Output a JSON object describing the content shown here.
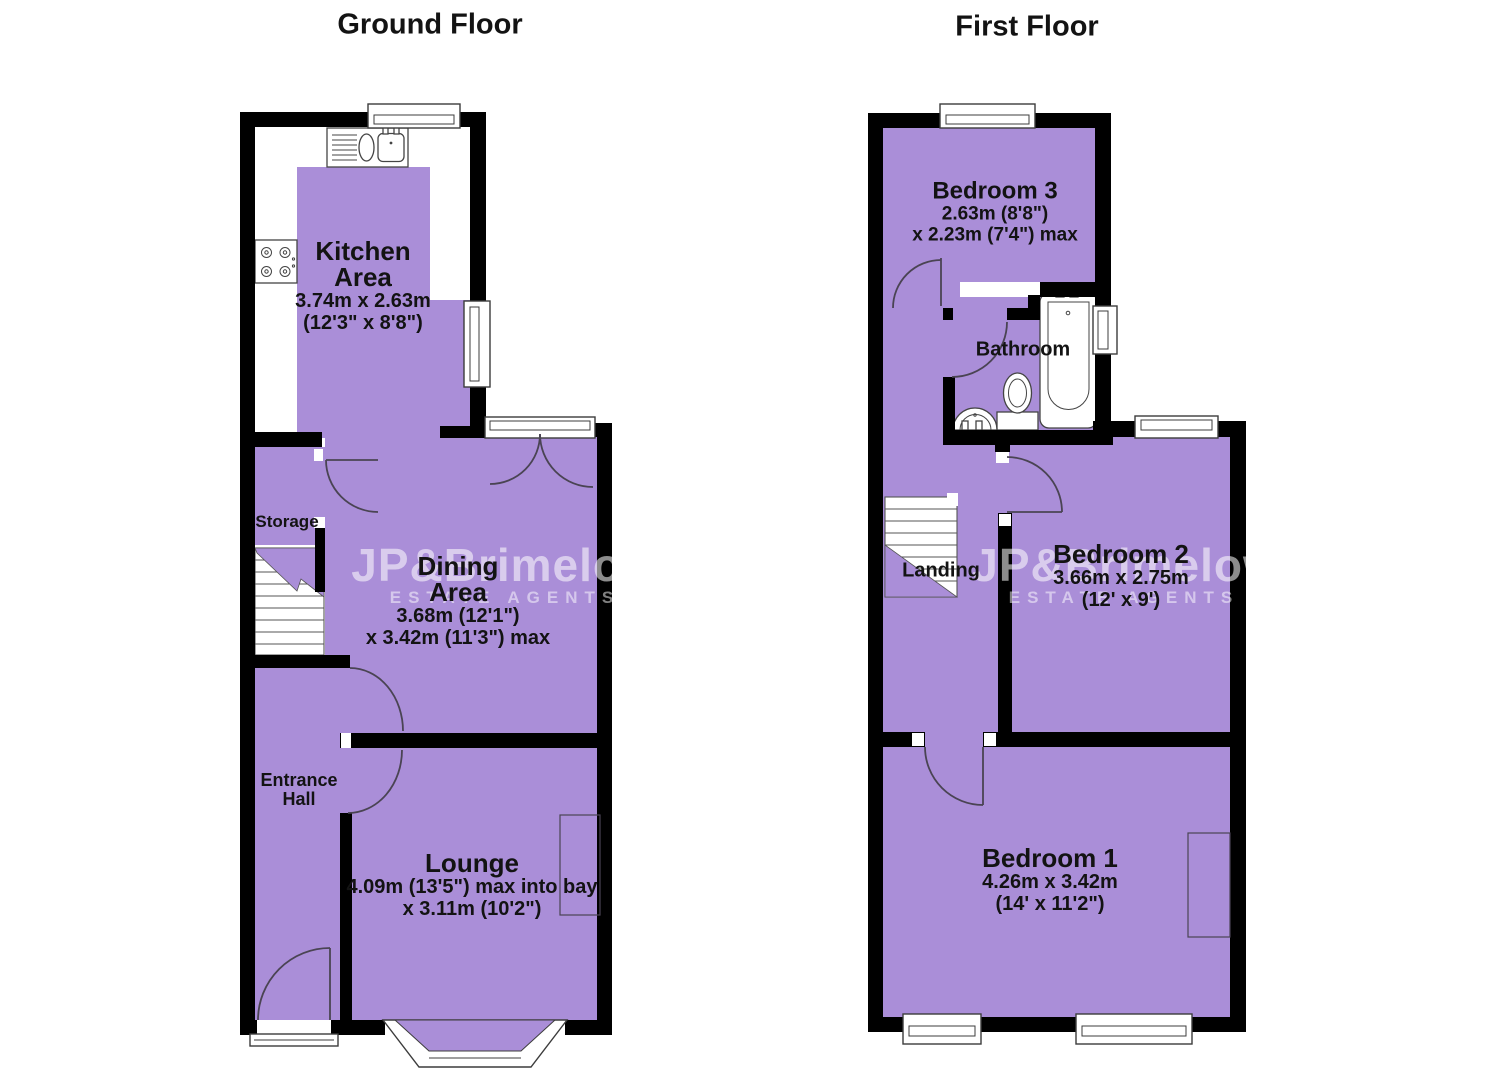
{
  "colors": {
    "room_fill": "#aa8ed8",
    "wall": "#000000",
    "label_text": "#131313"
  },
  "watermark": {
    "main": "JP&Brimelow",
    "sub": "ESTATE AGENTS"
  },
  "ground_floor": {
    "title": "Ground Floor",
    "rooms": {
      "kitchen": {
        "line1": "Kitchen",
        "line2": "Area",
        "dim1": "3.74m x 2.63m",
        "dim2": "(12'3\" x 8'8\")"
      },
      "dining": {
        "line1": "Dining",
        "line2": "Area",
        "dim1": "3.68m (12'1\")",
        "dim2": "x 3.42m (11'3\") max"
      },
      "storage": {
        "name": "Storage"
      },
      "entrance_hall": {
        "line1": "Entrance",
        "line2": "Hall"
      },
      "lounge": {
        "name": "Lounge",
        "dim1": "4.09m (13'5\") max into bay",
        "dim2": "x 3.11m (10'2\")"
      }
    }
  },
  "first_floor": {
    "title": "First Floor",
    "rooms": {
      "bedroom3": {
        "name": "Bedroom 3",
        "dim1": "2.63m (8'8\")",
        "dim2": "x 2.23m (7'4\") max"
      },
      "bathroom": {
        "name": "Bathroom"
      },
      "landing": {
        "name": "Landing"
      },
      "bedroom2": {
        "name": "Bedroom 2",
        "dim1": "3.66m x 2.75m",
        "dim2": "(12' x 9')"
      },
      "bedroom1": {
        "name": "Bedroom 1",
        "dim1": "4.26m x 3.42m",
        "dim2": "(14' x 11'2\")"
      }
    }
  }
}
